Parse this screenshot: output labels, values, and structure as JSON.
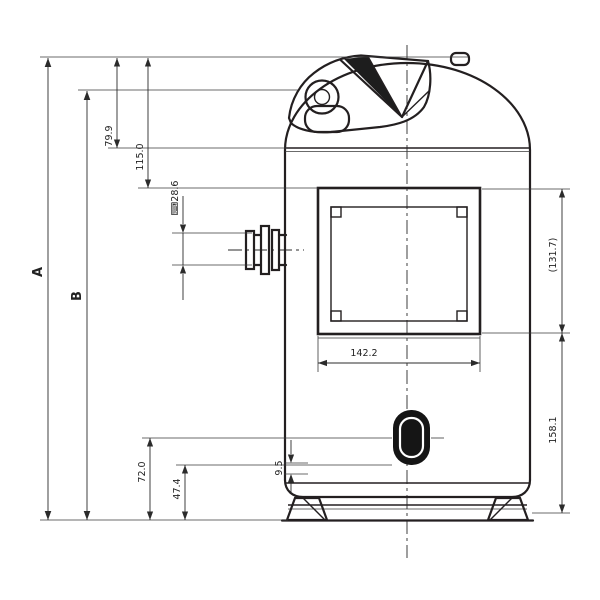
{
  "drawing": {
    "type": "technical-dimension-drawing",
    "subject": "hermetic compressor outline, front view",
    "labels": {
      "overall_height": "A",
      "shell_height": "B",
      "top_cap_height": "79.9",
      "top_to_bracket": "115.0",
      "suction_pipe_od": "⌨28.6",
      "plug_center_to_base": "72.0",
      "plug_bottom_to_base": "47.4",
      "base_seam_offset": "9.5",
      "bracket_width": "142.2",
      "bracket_height": "(131.7)",
      "bracket_to_base": "158.1"
    },
    "line_color": "#231f20",
    "background": "#ffffff"
  }
}
